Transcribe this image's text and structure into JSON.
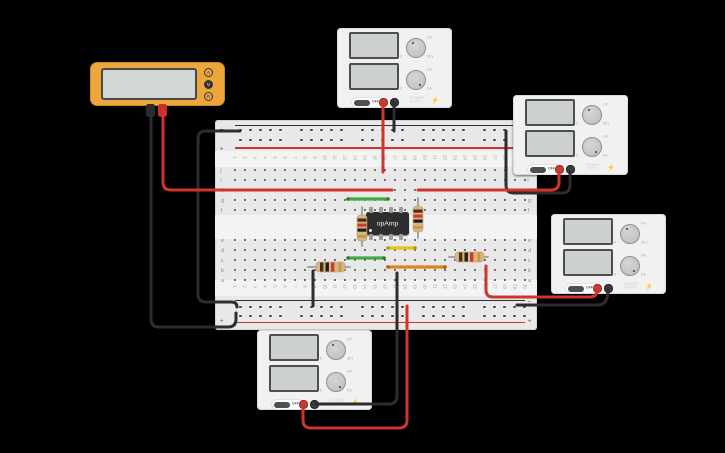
{
  "background": "#000000",
  "breadboard": {
    "column_numbers": [
      "1",
      "2",
      "3",
      "4",
      "5",
      "6",
      "7",
      "8",
      "9",
      "10",
      "11",
      "12",
      "13",
      "14",
      "15",
      "16",
      "17",
      "18",
      "19",
      "20",
      "21",
      "22",
      "23",
      "24",
      "25",
      "26",
      "27",
      "28",
      "29",
      "30"
    ],
    "row_labels_top": [
      "j",
      "i",
      "h",
      "g",
      "f"
    ],
    "row_labels_bottom": [
      "e",
      "d",
      "c",
      "b",
      "a"
    ],
    "rail_minus_symbol": "−",
    "rail_plus_symbol": "+",
    "colors": {
      "board": "#e8e8e8",
      "light_band": "#f3f3f3",
      "dot": "#454545",
      "plus_line": "#c8362d",
      "minus_line": "#303030"
    }
  },
  "chip": {
    "label": "opAmp",
    "body_color": "#2e2e2e"
  },
  "multimeter": {
    "body_color": "#eda63b",
    "buttons": [
      {
        "label": "A",
        "selected": false
      },
      {
        "label": "V",
        "selected": true
      },
      {
        "label": "R",
        "selected": false
      }
    ]
  },
  "power_supply": {
    "off_label": "OFF",
    "brand_line1": "VOLTAGE",
    "brand_line2": "SUPPLY",
    "bolt": "⚡",
    "knobs": [
      {
        "min": "0",
        "max": "30 V",
        "reading": "0 V"
      },
      {
        "min": "0",
        "max": "5 A",
        "reading": "0 A"
      }
    ]
  },
  "power_supply_instances": [
    {
      "id": "psu-top"
    },
    {
      "id": "psu-right-top"
    },
    {
      "id": "psu-right-middle"
    },
    {
      "id": "psu-bottom"
    }
  ],
  "resistors": [
    {
      "name": "resistor-vertical-left",
      "orientation": "vertical",
      "location": "column 14, rows f-d",
      "body_color": "#d6b784",
      "lead_color": "#9b9b9b",
      "band_colors": [
        "#4a2e15",
        "#cf3a2c",
        "#1e1e1e",
        "#c19a43"
      ]
    },
    {
      "name": "resistor-vertical-right",
      "orientation": "vertical",
      "location": "column 19, rows g-e",
      "body_color": "#d6b784",
      "lead_color": "#9b9b9b",
      "band_colors": [
        "#4a2e15",
        "#cf3a2c",
        "#1e1e1e",
        "#c19a43"
      ]
    },
    {
      "name": "resistor-horizontal-left",
      "orientation": "horizontal",
      "location": "row b, columns 9-12",
      "body_color": "#d6b784",
      "lead_color": "#9b9b9b",
      "band_colors": [
        "#4a2e15",
        "#1e1e1e",
        "#cf3a2c",
        "#c19a43"
      ]
    },
    {
      "name": "resistor-horizontal-right",
      "orientation": "horizontal",
      "location": "row c, columns 23-26",
      "body_color": "#d6b784",
      "lead_color": "#9b9b9b",
      "band_colors": [
        "#4a2e15",
        "#1e1e1e",
        "#cf3a2c",
        "#c19a43"
      ]
    }
  ],
  "jumper_wires": [
    {
      "name": "green-jumper-top",
      "color": "#44a944",
      "cap_color": "#2d7a2d",
      "from": "row g col 12",
      "to": "row g col 16"
    },
    {
      "name": "green-jumper-bottom",
      "color": "#44a944",
      "cap_color": "#2d7a2d",
      "from": "row c col 12",
      "to": "row c col 16"
    },
    {
      "name": "yellow-jumper",
      "color": "#e6c215",
      "cap_color": "#b5960d",
      "from": "row d col 16",
      "to": "row d col 19"
    },
    {
      "name": "orange-jumper",
      "color": "#e0821f",
      "cap_color": "#a85e13",
      "from": "row b col 16",
      "to": "row b col 22"
    }
  ],
  "connection_wires": [
    {
      "name": "multimeter-black-wire",
      "color": "#2d2d2d",
      "from": "multimeter black probe",
      "to": "bottom rail col 1"
    },
    {
      "name": "rail-loop-black-wire",
      "color": "#2d2d2d",
      "from": "top minus rail col 1",
      "to": "bottom rail col 1"
    },
    {
      "name": "row-a-to-rail-black-wire",
      "color": "#2d2d2d",
      "from": "row a col 9",
      "to": "bottom rail col 9"
    },
    {
      "name": "psu-top-black-wire",
      "color": "#2d2d2d",
      "from": "psu-top black terminal",
      "to": "top minus rail"
    },
    {
      "name": "psu-right-top-black-wire",
      "color": "#2d2d2d",
      "from": "psu-right-top black terminal",
      "to": "top minus rail col 28"
    },
    {
      "name": "psu-bottom-black-wire",
      "color": "#2d2d2d",
      "from": "psu-bottom black terminal",
      "to": "row a col 17"
    },
    {
      "name": "psu-right-middle-black-wire",
      "color": "#2d2d2d",
      "from": "psu-right-middle black terminal",
      "to": "bottom rail col 29"
    },
    {
      "name": "multimeter-red-wire",
      "color": "#d0342c",
      "from": "multimeter red probe",
      "to": "row h col 16"
    },
    {
      "name": "psu-top-red-wire",
      "color": "#d0342c",
      "from": "psu-top red terminal",
      "to": "row j col 15"
    },
    {
      "name": "psu-right-top-red-wire",
      "color": "#d0342c",
      "from": "psu-right-top red terminal",
      "to": "row h col 19"
    },
    {
      "name": "psu-bottom-red-wire",
      "color": "#d0342c",
      "from": "psu-bottom red terminal",
      "to": "bottom rail col 18"
    },
    {
      "name": "psu-right-middle-red-wire",
      "color": "#d0342c",
      "from": "psu-right-middle red terminal",
      "to": "row b col 26"
    }
  ]
}
